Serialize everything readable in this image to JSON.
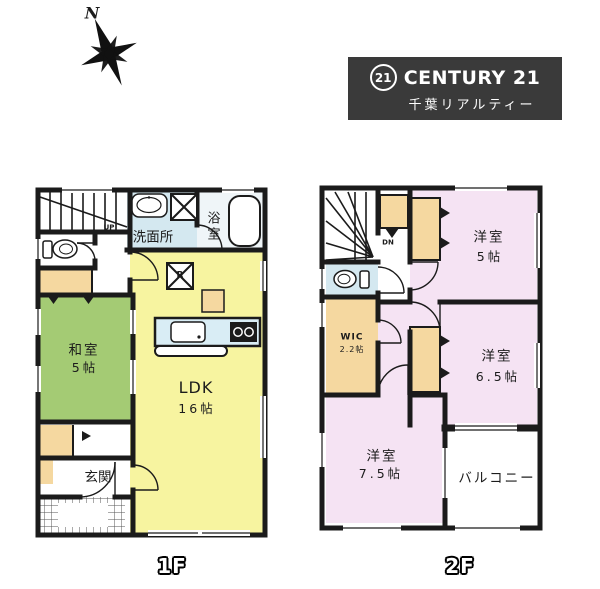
{
  "compass": {
    "north_label": "N"
  },
  "logo": {
    "circle_text": "21",
    "brand": "CENTURY 21",
    "subtitle": "千葉リアルティー"
  },
  "floor1": {
    "label": "1F",
    "stairs_label": "UP",
    "rooms": {
      "washroom": "洗面所",
      "bathroom": "浴室",
      "ldk_name": "LDK",
      "ldk_size": "16帖",
      "washitsu_name": "和室",
      "washitsu_size": "5帖",
      "genkan": "玄関"
    },
    "fixtures": {
      "refrigerator_mark": "R"
    }
  },
  "floor2": {
    "label": "2F",
    "stairs_label": "DN",
    "rooms": {
      "room5_name": "洋室",
      "room5_size": "5帖",
      "room65_name": "洋室",
      "room65_size": "6.5帖",
      "room75_name": "洋室",
      "room75_size": "7.5帖",
      "wic_name": "WIC",
      "wic_size": "2.2帖",
      "balcony": "バルコニー"
    }
  },
  "colors": {
    "wall": "#1b1b1b",
    "ldk_yellow": "#f7f4a0",
    "tatami_green": "#a4cb74",
    "bedroom_pink": "#f5e3f3",
    "closet_tan": "#f5d8a0",
    "wet_blue": "#d4e8f0",
    "logo_bg": "#3a3a3a"
  }
}
